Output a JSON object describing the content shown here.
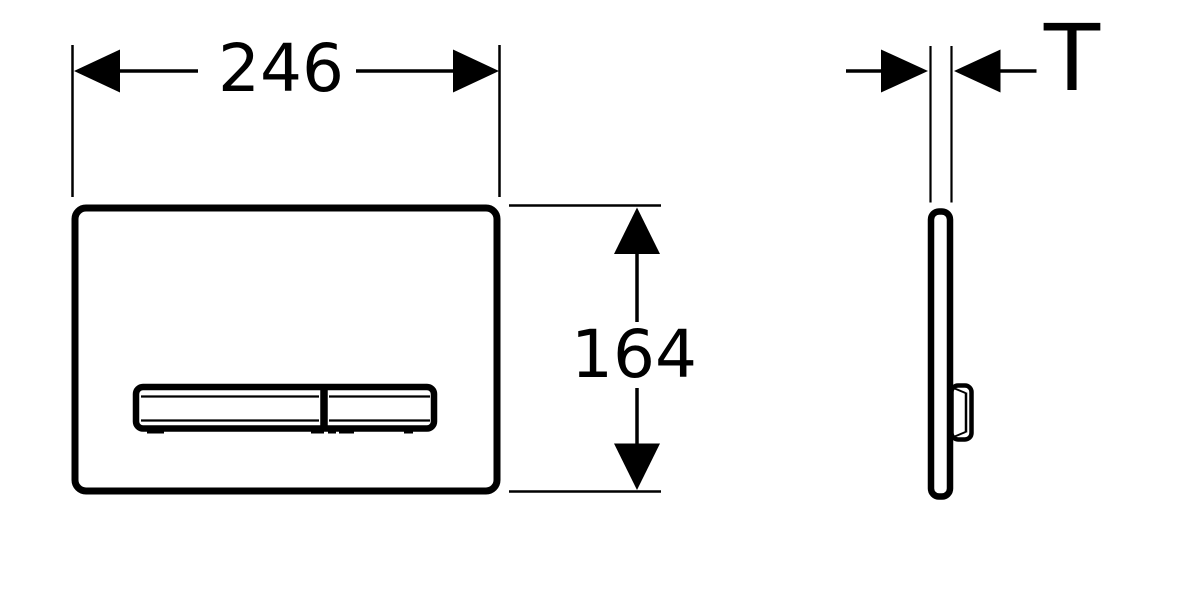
{
  "drawing": {
    "width_label": "246",
    "height_label": "164",
    "thickness_label": "T",
    "colors": {
      "line": "#000000",
      "background": "#ffffff"
    }
  }
}
